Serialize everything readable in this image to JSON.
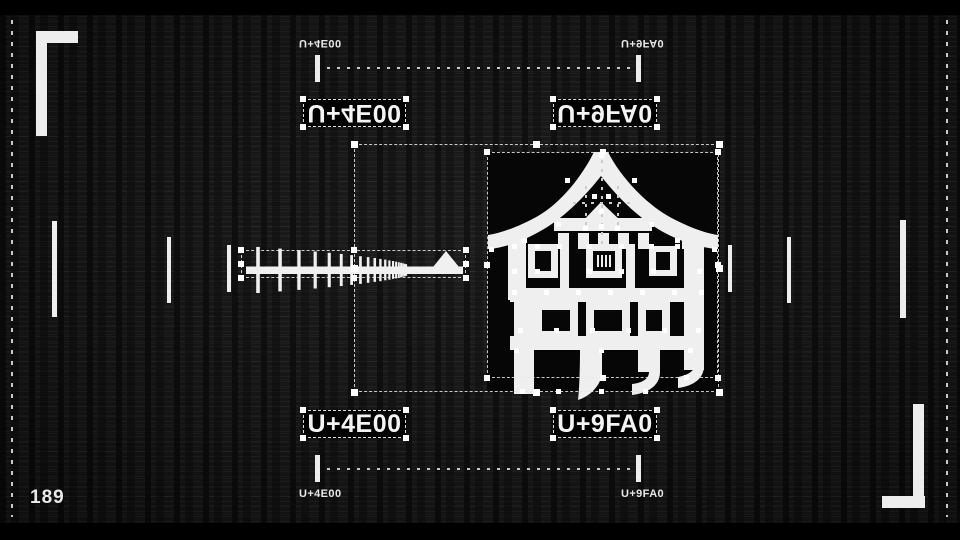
{
  "frame": {
    "counter": "189"
  },
  "colors": {
    "background": "#151515",
    "letterbox": "#000000",
    "foreground": "#f2f2f2",
    "glyph_backdrop": "#060606"
  },
  "sections": {
    "top": {
      "left_label": "U+4E00",
      "right_label": "U+9FA0",
      "left_caption": "U+4E00",
      "right_caption": "U+9FA0"
    },
    "bottom": {
      "left_label": "U+4E00",
      "right_label": "U+9FA0",
      "left_caption": "U+4E00",
      "right_caption": "U+9FA0"
    }
  },
  "glyphs": {
    "left_codepoint": "U+4E00",
    "right_codepoint": "U+9FA0"
  },
  "canvas": {
    "side_ticks": [
      {
        "x": 52,
        "y": 221,
        "w": 5,
        "h": 96
      },
      {
        "x": 167,
        "y": 237,
        "w": 4,
        "h": 66
      },
      {
        "x": 227,
        "y": 245,
        "w": 4,
        "h": 47
      },
      {
        "x": 728,
        "y": 245,
        "w": 4,
        "h": 47
      },
      {
        "x": 787,
        "y": 237,
        "w": 4,
        "h": 66
      },
      {
        "x": 900,
        "y": 220,
        "w": 6,
        "h": 98
      }
    ],
    "selection_boxes": [
      {
        "name": "selection-box-outer",
        "x": 354,
        "y": 144,
        "w": 365,
        "h": 248,
        "hs": 7
      },
      {
        "name": "selection-box-glyph-yue",
        "x": 487,
        "y": 152,
        "w": 231,
        "h": 226,
        "hs": 6
      },
      {
        "name": "selection-box-glyph-ichi",
        "x": 241,
        "y": 250,
        "w": 225,
        "h": 28,
        "hs": 6
      }
    ],
    "vguides": [
      {
        "x": 601,
        "y1": 160,
        "y2": 246
      },
      {
        "x": 585,
        "y1": 186,
        "y2": 230
      },
      {
        "x": 617,
        "y1": 186,
        "y2": 230
      }
    ],
    "hguides": [
      {
        "y": 202,
        "x1": 573,
        "x2": 630
      }
    ],
    "anchors": [
      [
        601,
        155
      ],
      [
        567,
        180
      ],
      [
        634,
        180
      ],
      [
        594,
        196
      ],
      [
        608,
        196
      ],
      [
        601,
        211
      ],
      [
        585,
        228
      ],
      [
        617,
        228
      ],
      [
        558,
        224
      ],
      [
        651,
        224
      ],
      [
        601,
        226
      ],
      [
        524,
        240
      ],
      [
        677,
        240
      ],
      [
        491,
        249
      ],
      [
        714,
        249
      ],
      [
        514,
        246
      ],
      [
        537,
        246
      ],
      [
        559,
        246
      ],
      [
        589,
        246
      ],
      [
        621,
        246
      ],
      [
        651,
        246
      ],
      [
        677,
        246
      ],
      [
        514,
        271
      ],
      [
        537,
        271
      ],
      [
        589,
        271
      ],
      [
        621,
        271
      ],
      [
        653,
        271
      ],
      [
        699,
        271
      ],
      [
        514,
        292
      ],
      [
        546,
        292
      ],
      [
        578,
        292
      ],
      [
        610,
        292
      ],
      [
        642,
        292
      ],
      [
        674,
        292
      ],
      [
        701,
        292
      ],
      [
        520,
        330
      ],
      [
        556,
        330
      ],
      [
        592,
        330
      ],
      [
        628,
        330
      ],
      [
        664,
        330
      ],
      [
        698,
        330
      ],
      [
        516,
        350
      ],
      [
        601,
        350
      ],
      [
        690,
        350
      ],
      [
        522,
        391
      ],
      [
        558,
        391
      ],
      [
        601,
        391
      ],
      [
        645,
        391
      ],
      [
        686,
        377
      ]
    ],
    "ichi": {
      "x0": 18,
      "count": 20,
      "gap0": 22,
      "gap_decay": 0.86,
      "h0": 46,
      "h_decay": 0.93,
      "w0": 3.6,
      "w_decay": 0.96,
      "center_y": 25
    }
  }
}
